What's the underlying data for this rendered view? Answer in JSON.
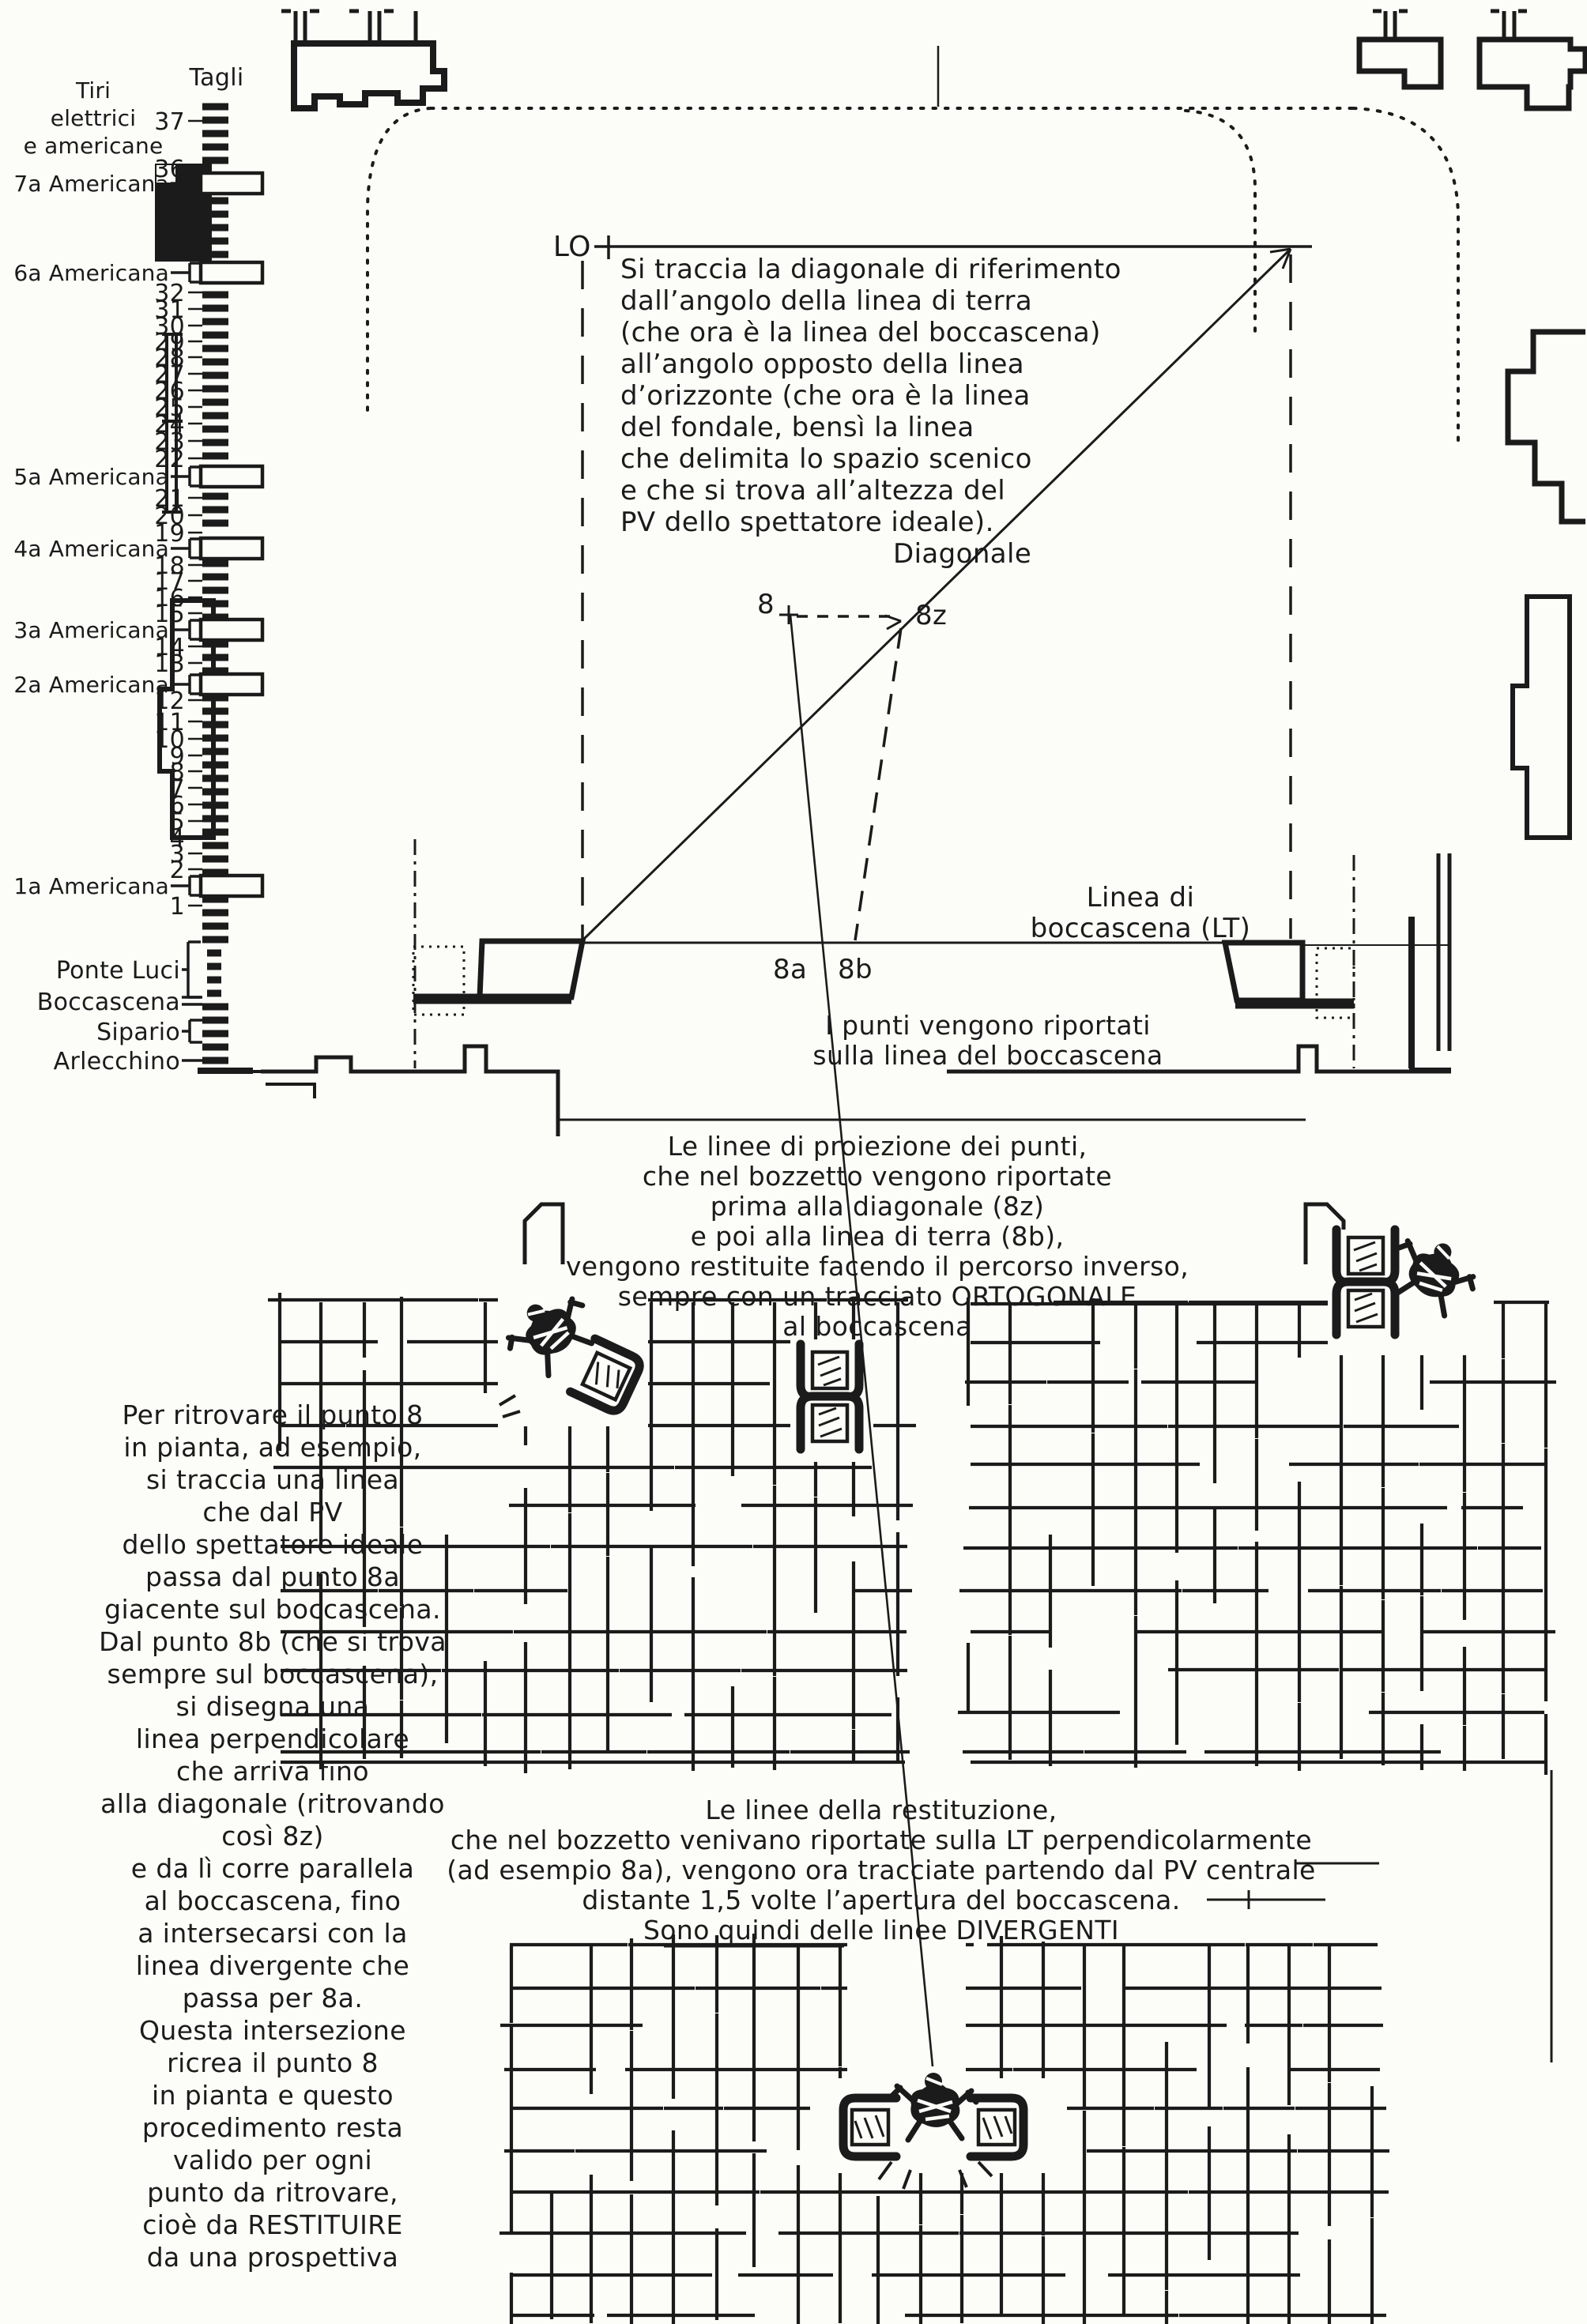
{
  "palette": {
    "paper": "#fcfcf9",
    "ink": "#1b1b1b"
  },
  "batten_schedule": {
    "col_header": "Tagli",
    "row_header_lines": [
      "Tiri",
      "elettrici",
      "e americane"
    ],
    "items": [
      {
        "label": "37",
        "kind": "number"
      },
      {
        "label": "36",
        "kind": "number"
      },
      {
        "label": "7a Americana",
        "kind": "americana"
      },
      {
        "label": "35",
        "kind": "number"
      },
      {
        "label": "34",
        "kind": "number"
      },
      {
        "label": "33",
        "kind": "number"
      },
      {
        "label": "6a Americana",
        "kind": "americana"
      },
      {
        "label": "32",
        "kind": "number"
      },
      {
        "label": "31",
        "kind": "number"
      },
      {
        "label": "30",
        "kind": "number"
      },
      {
        "label": "29",
        "kind": "number"
      },
      {
        "label": "28",
        "kind": "number"
      },
      {
        "label": "27",
        "kind": "number"
      },
      {
        "label": "26",
        "kind": "number"
      },
      {
        "label": "25",
        "kind": "number"
      },
      {
        "label": "24",
        "kind": "number"
      },
      {
        "label": "23",
        "kind": "number"
      },
      {
        "label": "22",
        "kind": "number"
      },
      {
        "label": "5a Americana",
        "kind": "americana"
      },
      {
        "label": "21",
        "kind": "number"
      },
      {
        "label": "20",
        "kind": "number"
      },
      {
        "label": "19",
        "kind": "number"
      },
      {
        "label": "4a Americana",
        "kind": "americana"
      },
      {
        "label": "18",
        "kind": "number"
      },
      {
        "label": "17",
        "kind": "number"
      },
      {
        "label": "16",
        "kind": "number"
      },
      {
        "label": "15",
        "kind": "number"
      },
      {
        "label": "3a Americana",
        "kind": "americana"
      },
      {
        "label": "14",
        "kind": "number"
      },
      {
        "label": "13",
        "kind": "number"
      },
      {
        "label": "2a Americana",
        "kind": "americana"
      },
      {
        "label": "12",
        "kind": "number"
      },
      {
        "label": "11",
        "kind": "number"
      },
      {
        "label": "10",
        "kind": "number"
      },
      {
        "label": "9",
        "kind": "number"
      },
      {
        "label": "8",
        "kind": "number"
      },
      {
        "label": "7",
        "kind": "number"
      },
      {
        "label": "6",
        "kind": "number"
      },
      {
        "label": "5",
        "kind": "number"
      },
      {
        "label": "4",
        "kind": "number"
      },
      {
        "label": "3",
        "kind": "number"
      },
      {
        "label": "2",
        "kind": "number"
      },
      {
        "label": "1a Americana",
        "kind": "americana"
      },
      {
        "label": "1",
        "kind": "number"
      },
      {
        "label": "Ponte Luci",
        "kind": "named"
      },
      {
        "label": "Boccascena",
        "kind": "named"
      },
      {
        "label": "Sipario",
        "kind": "named"
      },
      {
        "label": "Arlecchino",
        "kind": "named"
      }
    ]
  },
  "stage": {
    "lo_label": "LO",
    "diagonal_label": "Diagonale",
    "points": {
      "p8": "8",
      "p8z": "8z",
      "p8a": "8a",
      "p8b": "8b"
    },
    "boccascena_label_lines": [
      "Linea di",
      "boccascena (LT)"
    ],
    "instructions_lines": [
      "Si traccia la diagonale di riferimento",
      "dall’angolo della linea di terra",
      "(che ora è la linea del boccascena)",
      "all’angolo opposto della linea",
      "d’orizzonte (che ora è la linea",
      "del fondale, bensì la linea",
      "che delimita lo spazio scenico",
      "e che si trova all’altezza del",
      "PV dello spettatore ideale)."
    ]
  },
  "annotations": {
    "punti_lines": [
      "I punti vengono riportati",
      "sulla linea del boccascena"
    ],
    "proiezione_lines": [
      "Le linee di proiezione dei punti,",
      "che nel bozzetto vengono riportate",
      "prima alla diagonale (8z)",
      "e poi alla linea di terra (8b),",
      "vengono restituite facendo il percorso inverso,",
      "sempre con un tracciato ORTOGONALE",
      "al boccascena"
    ],
    "restituzione_lines": [
      "Le linee della restituzione,",
      "che nel bozzetto venivano riportate sulla LT perpendicolarmente",
      "(ad esempio 8a), vengono ora tracciate partendo dal PV centrale",
      "distante 1,5 volte l’apertura del boccascena.",
      "Sono quindi delle linee DIVERGENTI"
    ],
    "left_column_lines": [
      "Per ritrovare il punto 8",
      "in pianta, ad esempio,",
      "si traccia una linea",
      "che dal PV",
      "dello spettatore ideale",
      "passa dal punto 8a",
      "giacente sul boccascena.",
      "Dal punto 8b (che si trova",
      "sempre sul boccascena),",
      "si disegna una",
      "linea perpendicolare",
      "che arriva fino",
      "alla diagonale (ritrovando",
      "così 8z)",
      "e da lì corre parallela",
      "al boccascena, fino",
      "a intersecarsi con la",
      "linea divergente che",
      "passa per 8a.",
      "Questa intersezione",
      "ricrea il punto 8",
      "in pianta e questo",
      "procedimento resta",
      "valido per ogni",
      "punto da ritrovare,",
      "cioè da RESTITUIRE",
      "da una prospettiva"
    ]
  }
}
